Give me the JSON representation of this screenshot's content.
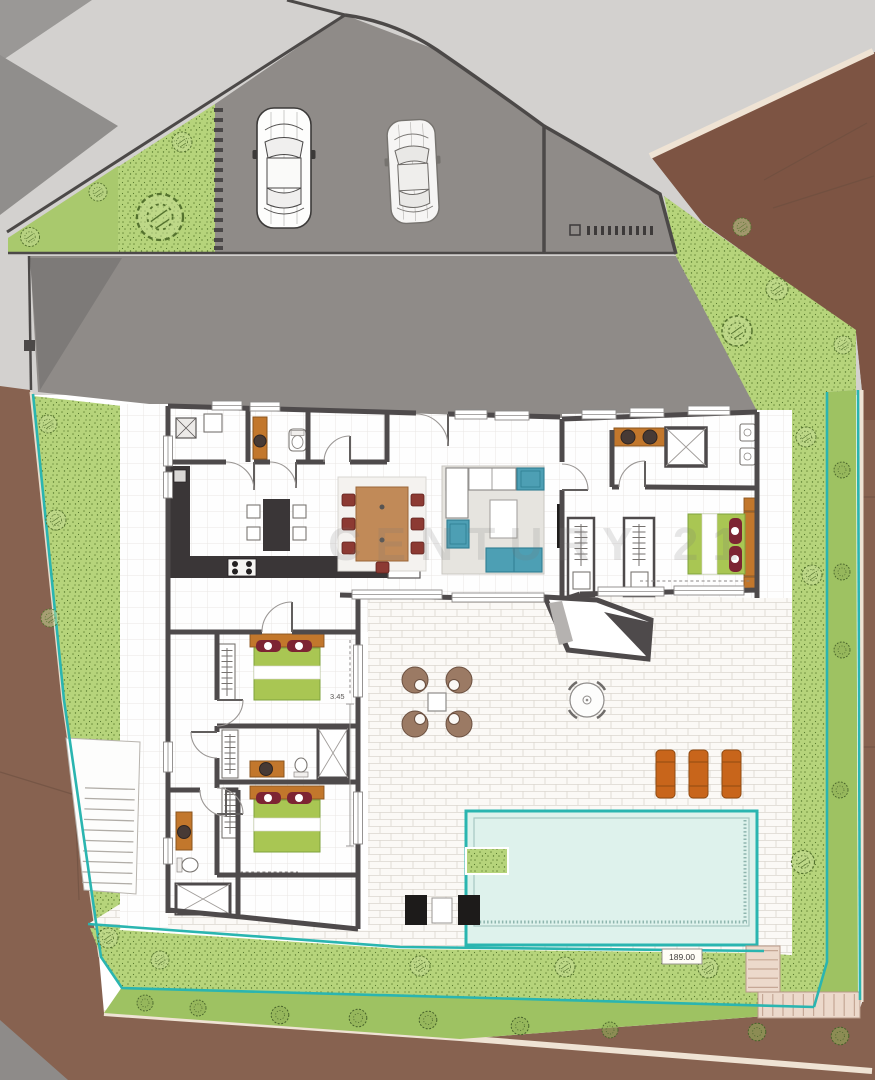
{
  "labels": {
    "watermark": "CENTURY 21",
    "plot_dimension": "189.00",
    "room_dimension": "3.45"
  },
  "palette": {
    "road_light": "#d3d1cf",
    "road_mid": "#908e8c",
    "asphalt": "#8f8b88",
    "curb": "#4c4948",
    "terrain_brown": "#876250",
    "terrain_brown_dark": "#7d5443",
    "beige_strip": "#efe3d4",
    "grass_stipple": "#b6d47b",
    "grass_flat": "#a9c96d",
    "grass_smooth": "#9ec262",
    "teal": "#2ab5b0",
    "wall": "#4e4a4b",
    "pool_water": "#def2ec",
    "cabinet_orange": "#c2772c",
    "sink_dark": "#473a35",
    "bed_green": "#a9c653",
    "pillow_red": "#7d2433",
    "wood": "#c18a58",
    "chair_red": "#8c3a33",
    "sofa_teal": "#4d9fb4",
    "rug": "#e6e4df",
    "counter_dark": "#3a3637",
    "lounger_orange": "#c8651b",
    "lounge_brown": "#9b7a64",
    "stair_beige": "#ecd9cb"
  },
  "inventory": {
    "cars": 2,
    "beds": 3,
    "bathrooms": 4,
    "swimming_pool": 1,
    "sun_loungers": 3,
    "outdoor_seating_sets": 2,
    "staircases": 2,
    "trees": 19,
    "shrubs": 13
  }
}
